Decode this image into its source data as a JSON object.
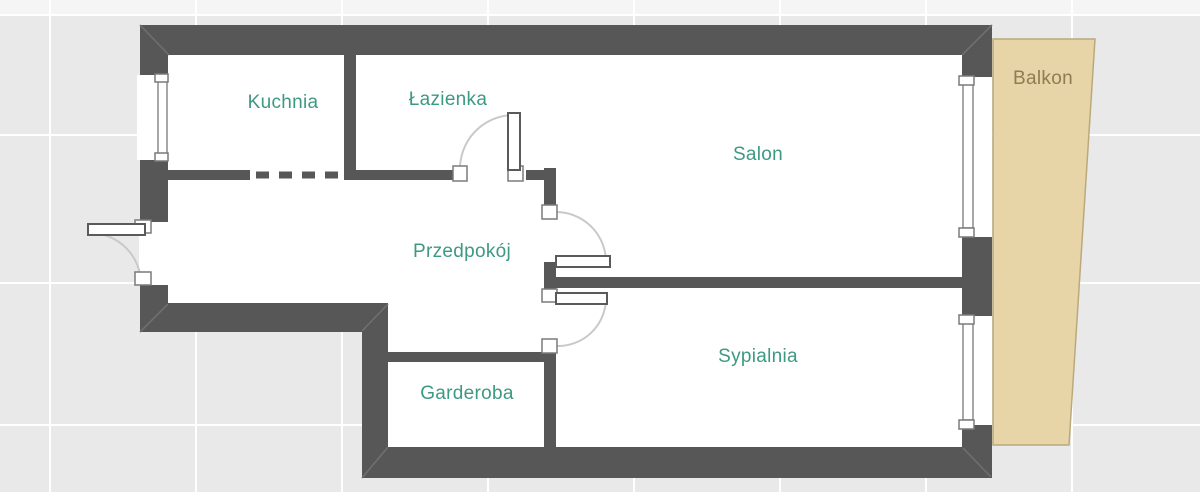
{
  "plan": {
    "rooms": [
      {
        "id": "kuchnia",
        "label": "Kuchnia"
      },
      {
        "id": "lazienka",
        "label": "Łazienka"
      },
      {
        "id": "salon",
        "label": "Salon"
      },
      {
        "id": "przedpokoj",
        "label": "Przedpokój"
      },
      {
        "id": "garderoba",
        "label": "Garderoba"
      },
      {
        "id": "sypialnia",
        "label": "Sypialnia"
      },
      {
        "id": "balkon",
        "label": "Balkon"
      }
    ],
    "colors": {
      "wall": "#575757",
      "background": "#e9e9e9",
      "background_top": "#f5f5f5",
      "grid_line": "#ffffff",
      "room_fill": "#ffffff",
      "balcony_fill": "#e7d4a7",
      "balcony_border": "#b9aa7e",
      "room_label": "#3d9982",
      "balcony_label": "#8d7d52",
      "frame_stroke": "#8a8a8a",
      "arc_stroke": "#c9c9c9",
      "seam": "#6f6f6f"
    }
  }
}
